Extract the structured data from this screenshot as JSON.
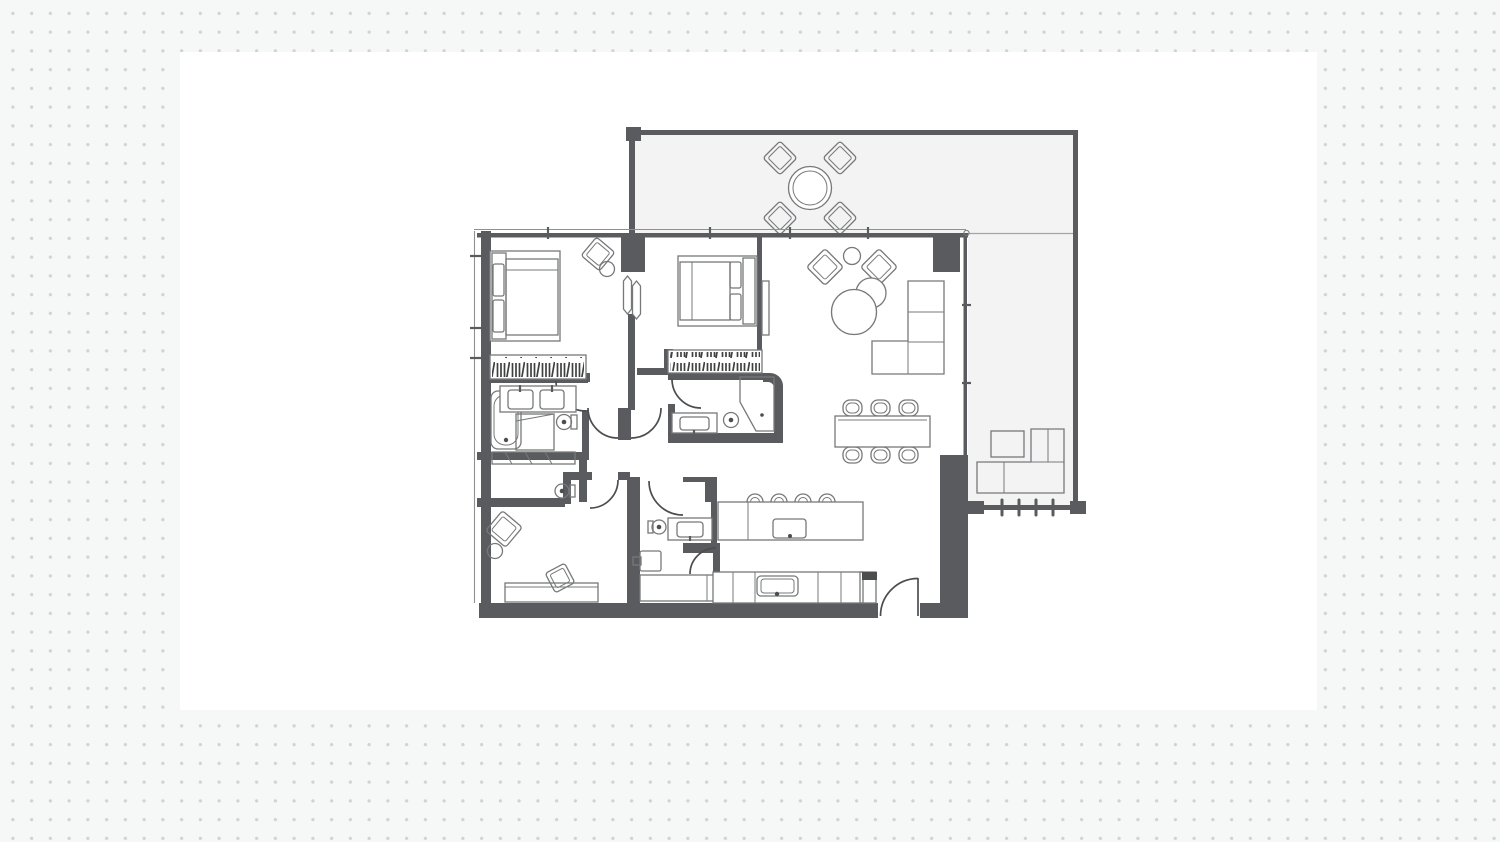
{
  "canvas": {
    "width": 1500,
    "height": 842
  },
  "colors": {
    "bg": "#f6f7f7",
    "dot": "#d0d2d3",
    "panel": "#ffffff",
    "wall": "#5a5b5e",
    "door": "#4c4d4f",
    "furn": "#77787a",
    "glass": "#8f9092",
    "terrace": "#f3f3f4"
  },
  "floorplan": {
    "label": "apartment-floor-plan",
    "icons": [
      "double-bed-icon",
      "wardrobe-hangers-icon",
      "armchair-icon",
      "round-side-table-icon",
      "bathtub-icon",
      "double-sink-vanity-icon",
      "toilet-icon",
      "shower-icon",
      "sofa-icon",
      "coffee-table-icon",
      "tv-panel-icon",
      "column-icon",
      "dining-table-icon",
      "dining-chair-icon",
      "kitchen-island-icon",
      "bar-stool-icon",
      "sink-icon",
      "cooktop-icon",
      "kitchen-counter-icon",
      "washer-icon",
      "desk-icon",
      "desk-chair-icon",
      "door-swing-icon",
      "window-icon",
      "outdoor-dining-table-icon",
      "outdoor-chair-icon",
      "outdoor-sofa-icon",
      "outdoor-coffee-table-icon",
      "terrace-railing-icon"
    ]
  }
}
